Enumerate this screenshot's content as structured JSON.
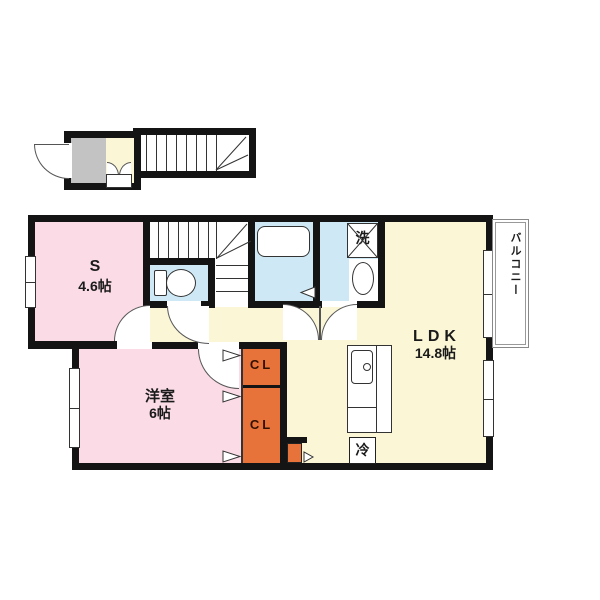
{
  "floorplan": {
    "rooms": {
      "service_room": {
        "label": "S",
        "size": "4.6帖"
      },
      "western_room": {
        "label": "洋室",
        "size": "6帖"
      },
      "ldk": {
        "label": "LDK",
        "size": "14.8帖"
      },
      "closet_upper": {
        "label": "CL"
      },
      "closet_lower": {
        "label": "CL"
      },
      "balcony": {
        "label": "バルコニー"
      }
    },
    "fixtures": {
      "washing_machine": {
        "label": "洗"
      },
      "refrigerator": {
        "label": "冷"
      }
    },
    "colors": {
      "room_pink": "#FADBE6",
      "room_cream": "#FAF6D6",
      "wet_area_blue": "#CEE9F5",
      "closet_orange": "#E8733A",
      "entry_gray": "#C3C3C3",
      "wall_black": "#141414"
    }
  }
}
